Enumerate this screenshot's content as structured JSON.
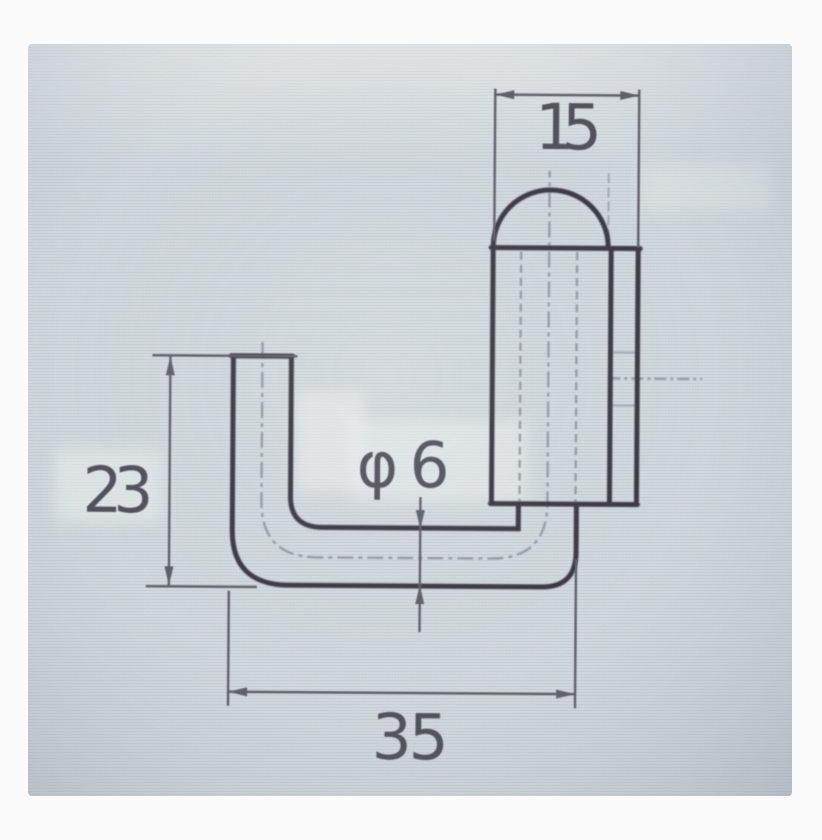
{
  "dimensions": {
    "top_width": "15",
    "left_height": "23",
    "bottom_length": "35",
    "rod_diameter": "φ6"
  },
  "colors": {
    "paper_margin": "#fbfbfb",
    "screen_background": "#d2d8dc",
    "outline": "#37343d",
    "dimension_lines": "#5d5d66",
    "dimension_text": "#4f4f59",
    "faint_lines": "#8f949c"
  }
}
